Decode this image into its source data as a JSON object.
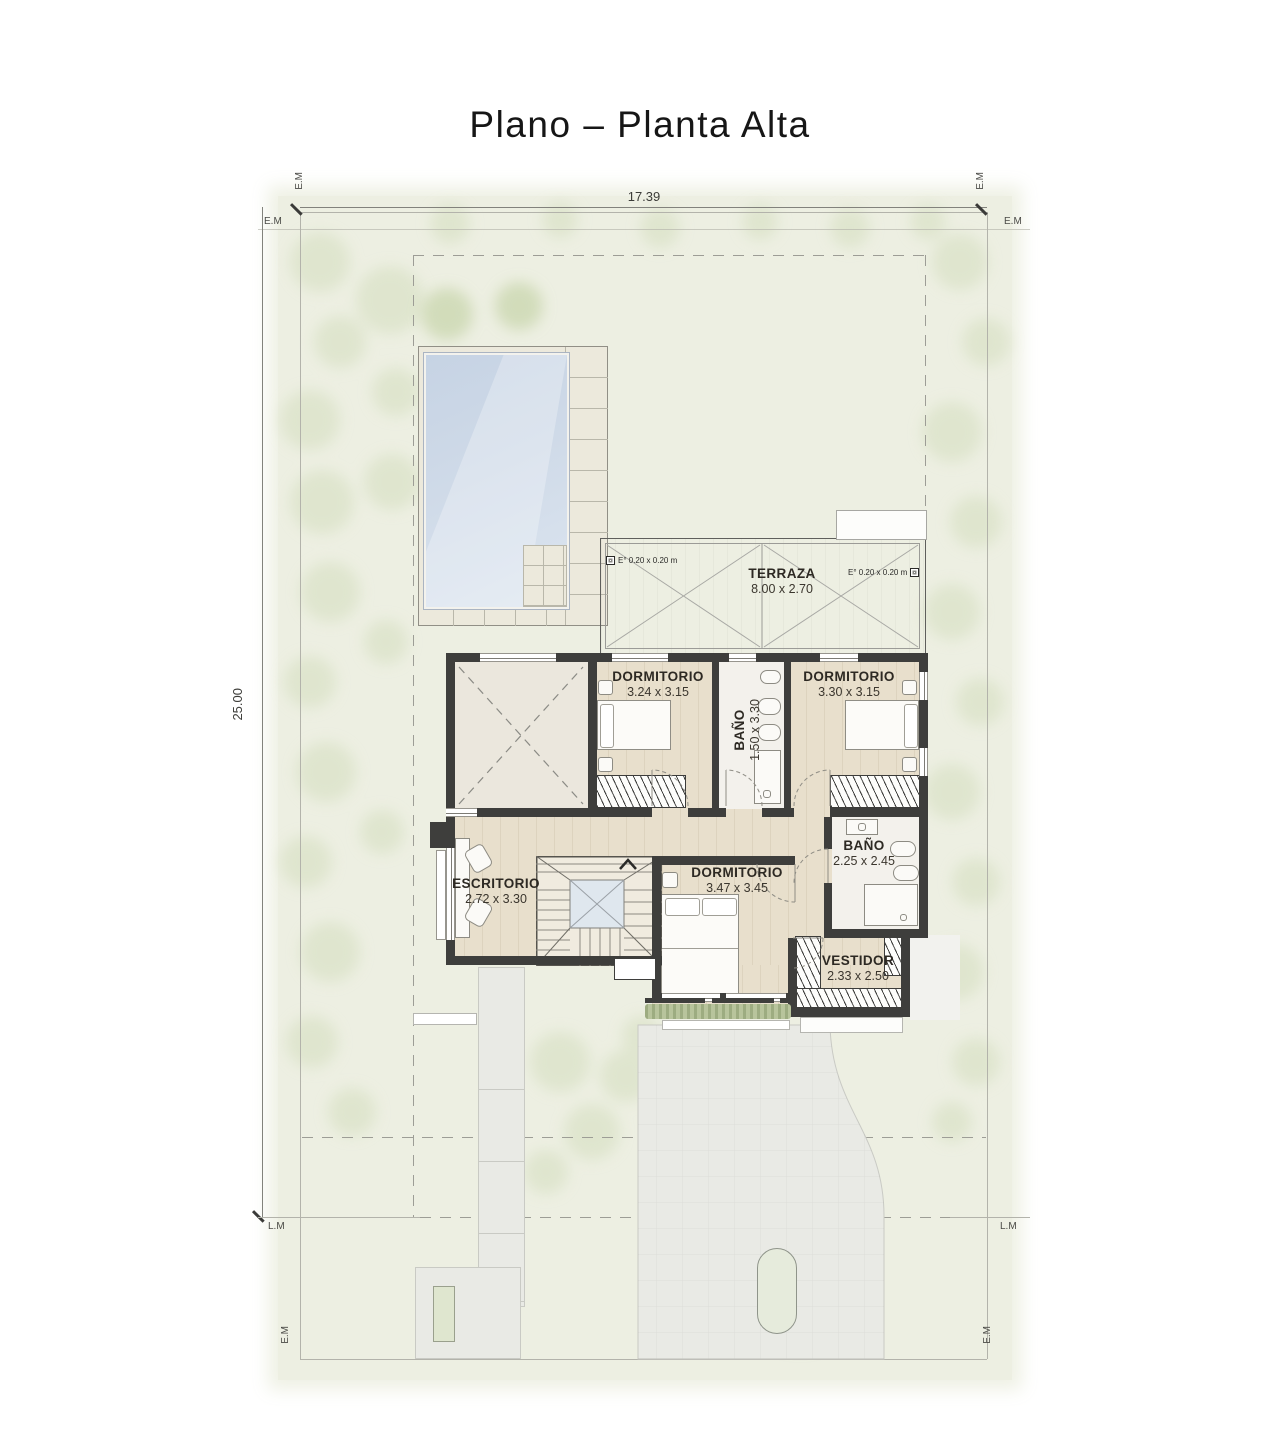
{
  "title": "Plano – Planta Alta",
  "dimensions": {
    "width": "17.39",
    "height": "25.00"
  },
  "boundary": {
    "em": "E.M",
    "lm": "L.M"
  },
  "rooms": [
    {
      "name": "TERRAZA",
      "size": "8.00 x 2.70"
    },
    {
      "name": "DORMITORIO",
      "size": "3.24 x 3.15"
    },
    {
      "name": "BAÑO",
      "size": "1.50 x 3.30"
    },
    {
      "name": "DORMITORIO",
      "size": "3.30 x 3.15"
    },
    {
      "name": "ESCRITORIO",
      "size": "2.72 x 3.30"
    },
    {
      "name": "DORMITORIO",
      "size": "3.47 x 3.45"
    },
    {
      "name": "BAÑO",
      "size": "2.25 x 2.45"
    },
    {
      "name": "VESTIDOR",
      "size": "2.33 x 2.50"
    }
  ],
  "annotations": {
    "column_note": "E° 0.20 x 0.20 m"
  },
  "colors": {
    "wall": "#3e3e3c",
    "floor_wood": "#e8dfcc",
    "terrace": "#d4d4d1",
    "pool_water": "#cdd8e6",
    "site_wash": "#edefe2",
    "foliage": "#d7e0c3"
  }
}
